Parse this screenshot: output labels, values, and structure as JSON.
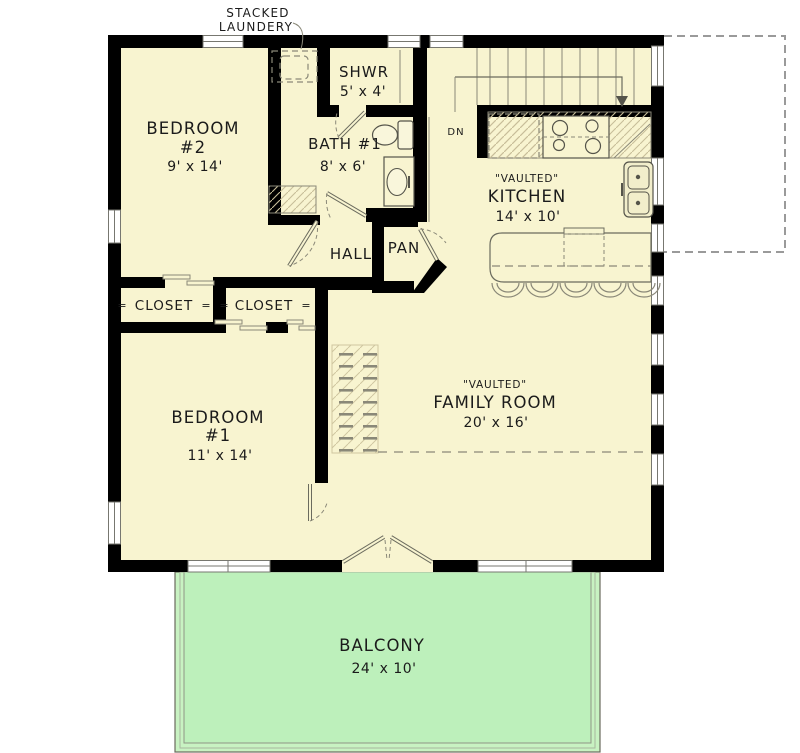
{
  "plan": {
    "laundry_callout": {
      "line1": "STACKED",
      "line2": "LAUNDERY"
    },
    "rooms": {
      "bedroom2": {
        "name": "BEDROOM",
        "number": "#2",
        "dims": "9' x 14'"
      },
      "shower": {
        "name": "SHWR",
        "dims": "5' x 4'"
      },
      "bath1": {
        "name": "BATH #1",
        "dims": "8' x 6'"
      },
      "kitchen": {
        "ceiling": "\"VAULTED\"",
        "name": "KITCHEN",
        "dims": "14' x 10'"
      },
      "hall": {
        "name": "HALL"
      },
      "pantry": {
        "name": "PAN"
      },
      "closet_left": {
        "name": "CLOSET"
      },
      "closet_right": {
        "name": "CLOSET"
      },
      "bedroom1": {
        "name": "BEDROOM",
        "number": "#1",
        "dims": "11' x 14'"
      },
      "family_room": {
        "ceiling": "\"VAULTED\"",
        "name": "FAMILY ROOM",
        "dims": "20' x 16'"
      },
      "balcony": {
        "name": "BALCONY",
        "dims": "24' x 10'"
      }
    },
    "stairs": {
      "down_label": "DN"
    },
    "slider_mark": "=",
    "colors": {
      "floor": "#f8f4d0",
      "balcony_fill": "#bdf0bb",
      "balcony_band": "#c8f2c2",
      "wall": "#000000",
      "line": "#6b6b5e",
      "hatch_line": "#c8be99",
      "dashed_outline": "#9a9a9a",
      "text": "#1b1b1b"
    }
  }
}
